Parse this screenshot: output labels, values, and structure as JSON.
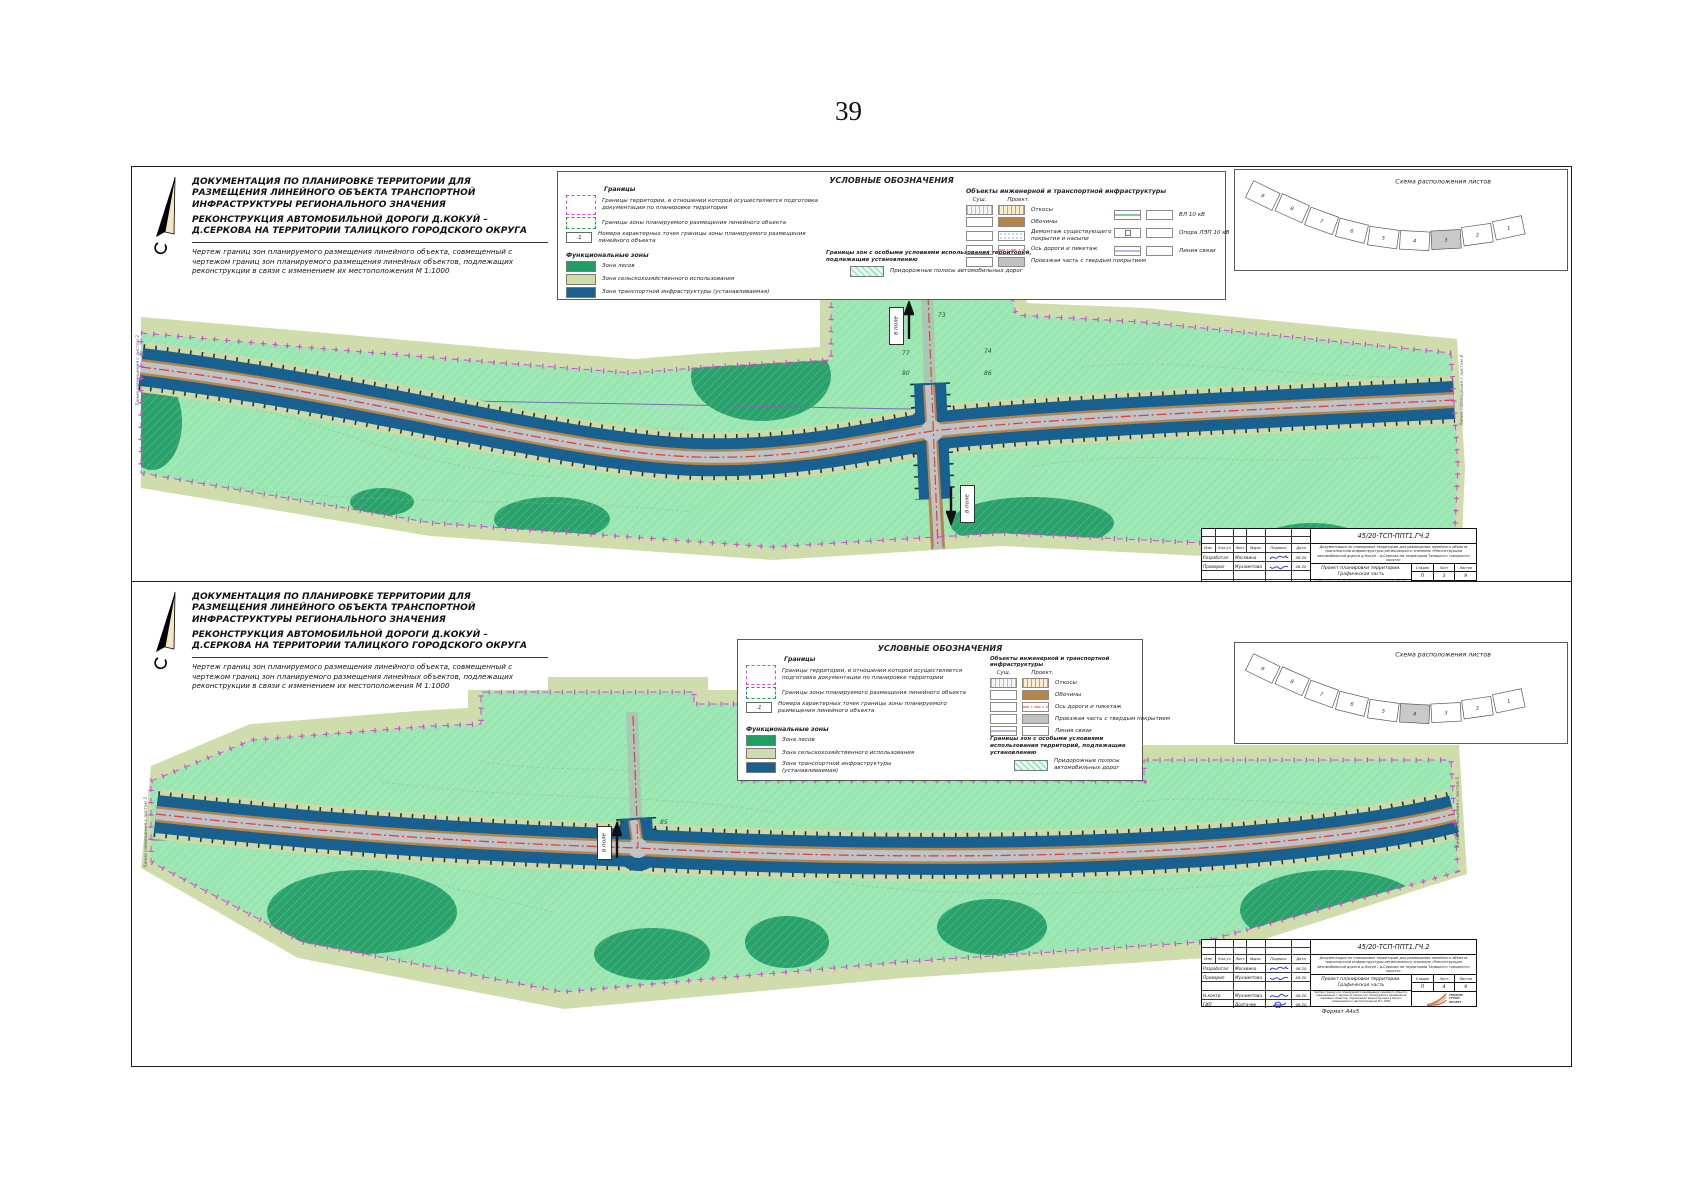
{
  "page_number": "39",
  "shared": {
    "title1": "ДОКУМЕНТАЦИЯ ПО ПЛАНИРОВКЕ ТЕРРИТОРИИ ДЛЯ РАЗМЕЩЕНИЯ ЛИНЕЙНОГО ОБЪЕКТА ТРАНСПОРТНОЙ ИНФРАСТРУКТУРЫ РЕГИОНАЛЬНОГО ЗНАЧЕНИЯ",
    "title2": "РЕКОНСТРУКЦИЯ АВТОМОБИЛЬНОЙ ДОРОГИ Д.КОКУЙ – Д.СЕРКОВА НА ТЕРРИТОРИИ ТАЛИЦКОГО ГОРОДСКОГО ОКРУГА",
    "title3": "Чертеж границ зон планируемого размещения линейного объекта, совмещенный с чертежом границ зон планируемого размещения линейных объектов, подлежащих реконструкции в связи с изменением их местоположения М 1:1000",
    "field_label": "в поле",
    "scheme_title": "Схема расположения листов",
    "sheet_numbers": [
      "9",
      "8",
      "7",
      "6",
      "5",
      "4",
      "3",
      "2",
      "1"
    ],
    "legend": {
      "title": "УСЛОВНЫЕ ОБОЗНАЧЕНИЯ",
      "granitsy": "Границы",
      "b1": "Границы территории, в отношении которой осуществляется подготовка документации по планировке территории",
      "b2": "Границы зоны планируемого размещения линейного объекта",
      "b3": "Номера характерных точек границы зоны планируемого размещения линейного объекта",
      "point_symbol": ".1",
      "func_zones": "Функциональные зоны",
      "z1": "Зона лесов",
      "z2": "Зона сельскохозяйственного использования",
      "z3": "Зона транспортной инфраструктуры (устанавливаемая)",
      "special_title": "Границы зон с особыми условиями использования территорий, подлежащие установлению",
      "special1": "Придорожные полосы автомобильных дорог",
      "infra_title": "Объекты инженерной и транспортной инфраструктуры",
      "col_sush": "Сущ.",
      "col_proekt": "Проект.",
      "i_otkosy": "Откосы",
      "i_obochiny": "Обочины",
      "i_demontazh": "Демонтаж существующего покрытия и насыпи",
      "i_os": "Ось дороги и пикетаж",
      "i_pokrytie": "Проезжая часть с твердым покрытием",
      "i_vl": "ВЛ 10 кВ",
      "i_opora": "Опора ЛЭП 10 кВ",
      "i_svyaz": "Линия связи"
    },
    "stamp": {
      "doc_number": "45/20-ТСП-ППТ1.ГЧ.2",
      "description": "Документация по планировке территории для размещения линейного объекта транспортной инфраструктуры регионального значения «Реконструкция автомобильной дороги д.Кокуй – д.Серкова на территории Талицкого городского округа»",
      "project_title": "Проект планировки территории. Графическая часть",
      "drawing_title": "Чертеж границ зон планируемого размещения линейного объекта, совмещенный с чертежом границ зон планируемого размещения линейных объектов, подлежащих реконструкции в связи с изменением их местоположения М 1:1000",
      "h_izm": "Изм.",
      "h_koluch": "Кол.уч",
      "h_list": "Лист",
      "h_ndok": "№док.",
      "h_podpis": "Подпись",
      "h_data": "Дата",
      "rows": [
        {
          "role": "Разработал",
          "name": "Москвина",
          "date": "08.20"
        },
        {
          "role": "Проверил",
          "name": "Мухаметова",
          "date": "08.20"
        },
        {
          "role": "Н.контр.",
          "name": "Мухаметова",
          "date": "08.20"
        },
        {
          "role": "ГИП",
          "name": "Долгачев",
          "date": "08.20"
        }
      ],
      "stage_label": "Стадия",
      "list_label": "Лист",
      "listov_label": "Листов",
      "stage": "П",
      "sheets_total": "9",
      "logo_line1": "ТЮМЕНЬ",
      "logo_line2": "СТРОЙ",
      "logo_line3": "ПРОЕКТ",
      "format_note": "Формат А4х5"
    }
  },
  "panel1": {
    "sheet": "3",
    "matchline_left": "Линия совмещения с листом 2",
    "matchline_right": "Линия совмещения с листом 4",
    "pt_a": "73",
    "pt_b": "74",
    "pt_c": "77",
    "pt_d": "80",
    "pt_e": "86"
  },
  "panel2": {
    "sheet": "4",
    "matchline_left": "Линия совмещения с листом 3",
    "matchline_right": "Линия совмещения с листом 5",
    "pt_a": "86",
    "pt_b": "85"
  },
  "colors": {
    "zone_forest": "#1f9e66",
    "zone_agro": "#cfdcab",
    "zone_transport": "#17608f",
    "roadside_strip": "#9ae6b1",
    "territory_boundary": "#d24ad2",
    "object_zone_boundary": "#22a04a",
    "road_axis": "#e04038",
    "pavement": "#c0c3c6",
    "shoulder": "#b5854b",
    "comm_line": "#a08cc8",
    "power_line": "#3fae4a",
    "demolition": "#2f49c9"
  }
}
